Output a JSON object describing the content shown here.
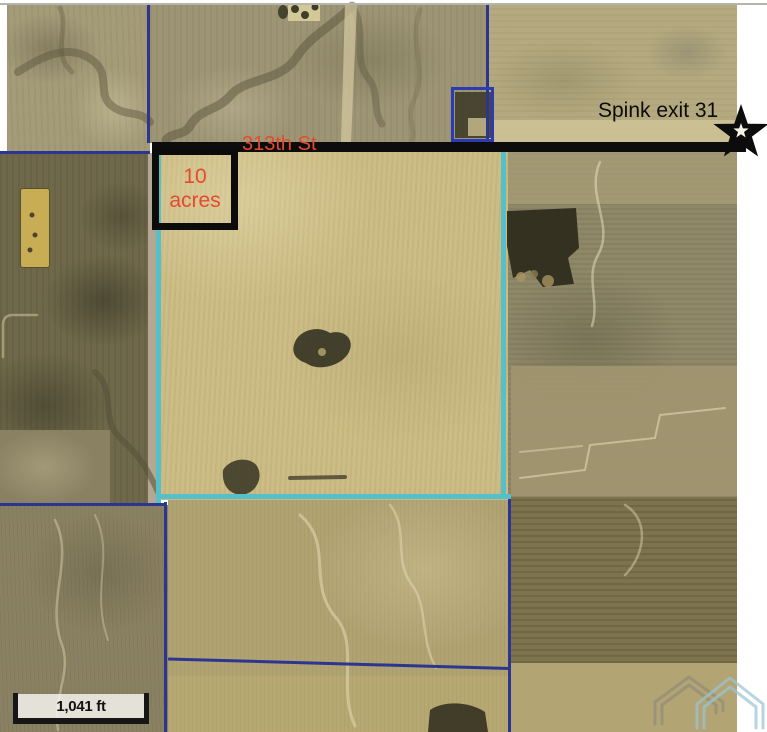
{
  "map": {
    "annotations": {
      "exit_label": "Spink exit 31",
      "street_label": "313th St",
      "parcel_size_line1": "10",
      "parcel_size_line2": "acres",
      "scale_label": "1,041 ft"
    },
    "colors": {
      "parcel_highlight_cyan": "#56bfc8",
      "property_line_blue": "#2c358f",
      "farmstead_outline_blue": "#2b3cb3",
      "road_black": "#0c0c0c",
      "annotation_red": "#e64a2e"
    },
    "icons": {
      "star_icon": "★",
      "logo_watermark": "double-roof-realty-logo"
    }
  }
}
